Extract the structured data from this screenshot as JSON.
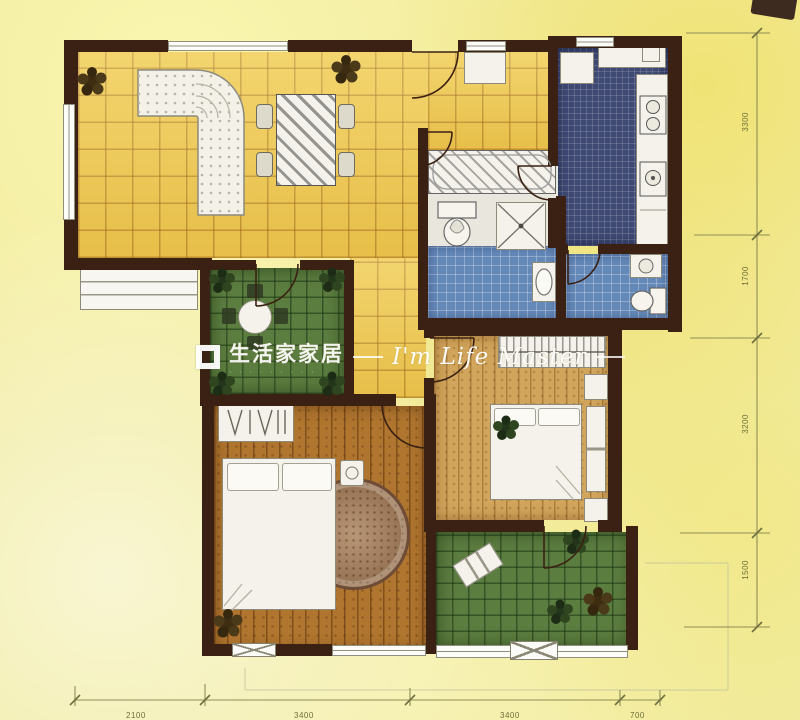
{
  "watermark": {
    "brand": "生活家家居",
    "tagline": "· · · · · · · · ·",
    "script": "I'm Life Master"
  },
  "dimensions": {
    "right": [
      "3300",
      "1700",
      "3200",
      "1500"
    ],
    "bottom": [
      "2100",
      "3400",
      "3400",
      "700"
    ]
  },
  "colors": {
    "wall": "#3a2113",
    "tile_yellow": "#eec94f",
    "tile_green": "#5c7d40",
    "tile_navy": "#3f4a74",
    "tile_blue": "#6488b8",
    "wood_dark": "#b0762f",
    "wood_light": "#d2a55c",
    "background": "#f1eb9e",
    "dimension_line": "#8f8e55",
    "watermark_text": "#ffffff"
  }
}
